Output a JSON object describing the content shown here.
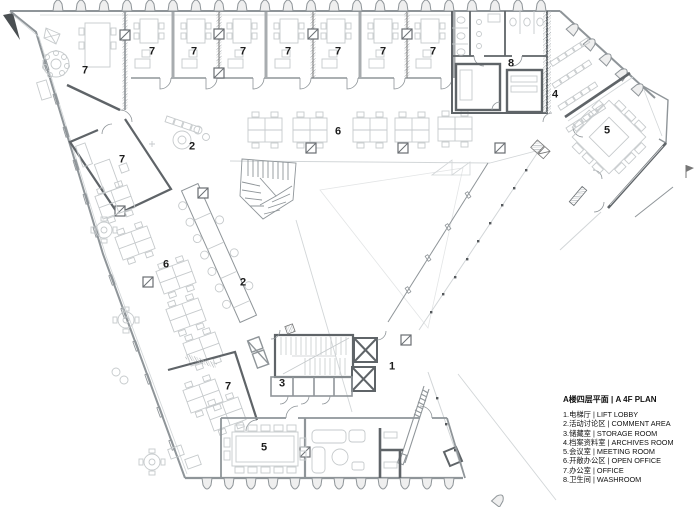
{
  "legend": {
    "title": "A楼四层平面 | A 4F PLAN",
    "items": [
      "1.电梯厅 | LIFT LOBBY",
      "2.活动讨论区 | COMMENT AREA",
      "3.储藏室 | STORAGE ROOM",
      "4.档案资料室 | ARCHIVES ROOM",
      "5.会议室 | MEETING ROOM",
      "6.开敞办公区 | OPEN OFFICE",
      "7.办公室 | OFFICE",
      "8.卫生间 | WASHROOM"
    ]
  },
  "plan": {
    "room_labels": [
      {
        "label": "7",
        "x": 85,
        "y": 71
      },
      {
        "label": "7",
        "x": 152,
        "y": 52
      },
      {
        "label": "7",
        "x": 194,
        "y": 52
      },
      {
        "label": "7",
        "x": 243,
        "y": 52
      },
      {
        "label": "7",
        "x": 288,
        "y": 52
      },
      {
        "label": "7",
        "x": 338,
        "y": 52
      },
      {
        "label": "7",
        "x": 383,
        "y": 52
      },
      {
        "label": "7",
        "x": 433,
        "y": 52
      },
      {
        "label": "8",
        "x": 511,
        "y": 64
      },
      {
        "label": "4",
        "x": 555,
        "y": 95
      },
      {
        "label": "5",
        "x": 607,
        "y": 131
      },
      {
        "label": "2",
        "x": 192,
        "y": 147
      },
      {
        "label": "7",
        "x": 122,
        "y": 160
      },
      {
        "label": "6",
        "x": 338,
        "y": 132
      },
      {
        "label": "6",
        "x": 166,
        "y": 265
      },
      {
        "label": "2",
        "x": 243,
        "y": 283
      },
      {
        "label": "3",
        "x": 282,
        "y": 384
      },
      {
        "label": "7",
        "x": 228,
        "y": 387
      },
      {
        "label": "1",
        "x": 392,
        "y": 367
      },
      {
        "label": "5",
        "x": 264,
        "y": 448
      }
    ]
  },
  "colors": {
    "wall": "#8f9599",
    "furniture": "#c6cacc",
    "dark_wall": "#5f6468",
    "label": "#1c1c1c",
    "background": "#ffffff"
  }
}
